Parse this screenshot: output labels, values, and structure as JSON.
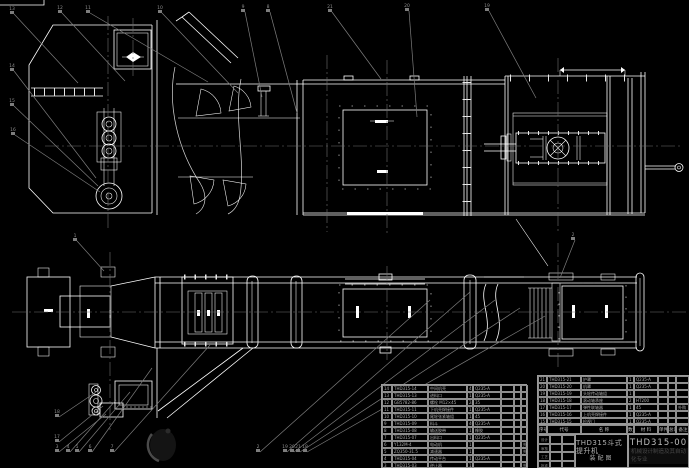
{
  "colors": {
    "background": "#000000",
    "line": "#ffffff",
    "leader": "#7d7d7d",
    "table_line": "#9a9a9a",
    "table_text": "#aeaeae",
    "title_text": "#bcbcbc",
    "org_text": "#474747",
    "watermark": "#161616"
  },
  "title_block": {
    "product": "THD315斗式提升机",
    "doc_type": "装配图",
    "drawing_no": "THD315-00",
    "org": "机械设计制造及其自动化专业",
    "signature_labels": [
      "设计",
      "审核",
      "工艺",
      "批准"
    ]
  },
  "bom": {
    "header": [
      "序号",
      "代号",
      "名 称",
      "数量",
      "材 料",
      "单件",
      "总计",
      "备注"
    ],
    "right_rows": [
      [
        "21",
        "THD315-21",
        "护罩",
        "1",
        "Q235-A",
        "",
        "",
        ""
      ],
      [
        "20",
        "THD315-20",
        "机罩",
        "1",
        "Q235-A",
        "",
        "",
        ""
      ],
      [
        "19",
        "THD315-19",
        "头轮传动轴组",
        "1",
        "",
        "",
        "",
        ""
      ],
      [
        "18",
        "THD315-18",
        "滚动轴承座",
        "2",
        "HT200",
        "",
        "",
        ""
      ],
      [
        "17",
        "THD315-17",
        "弹性联轴器",
        "1",
        "45",
        "",
        "",
        "外购"
      ],
      [
        "16",
        "THD315-16",
        "上机壳焊接件",
        "1",
        "Q235-A",
        "",
        "",
        ""
      ],
      [
        "15",
        "THD315-15",
        "检视门",
        "1",
        "Q235-A",
        "",
        "",
        ""
      ]
    ],
    "left_rows": [
      [
        "14",
        "THD315-14",
        "中间机壳",
        "4",
        "Q235-A",
        "",
        "",
        ""
      ],
      [
        "13",
        "THD315-13",
        "进料口",
        "1",
        "Q235-A",
        "",
        "",
        ""
      ],
      [
        "12",
        "GB5782-86",
        "螺栓 M12×45",
        "24",
        "35",
        "",
        "",
        ""
      ],
      [
        "11",
        "THD315-11",
        "下机壳焊接件",
        "1",
        "Q235-A",
        "",
        "",
        ""
      ],
      [
        "10",
        "THD315-10",
        "尾轮张紧轴组",
        "1",
        "45",
        "",
        "",
        ""
      ],
      [
        "9",
        "THD315-09",
        "料斗",
        "46",
        "Q235-A",
        "",
        "",
        ""
      ],
      [
        "8",
        "THD315-08",
        "输送胶带",
        "1",
        "橡胶",
        "",
        "",
        ""
      ],
      [
        "7",
        "THD315-07",
        "出料口",
        "1",
        "Q235-A",
        "",
        "",
        ""
      ],
      [
        "6",
        "Y132M-4",
        "电动机",
        "1",
        "",
        "",
        "",
        "外购"
      ],
      [
        "5",
        "ZQ350-31.5",
        "减速器",
        "1",
        "",
        "",
        "",
        "外购"
      ],
      [
        "4",
        "THD315-04",
        "传动平台",
        "1",
        "Q235-A",
        "",
        "",
        ""
      ],
      [
        "3",
        "THD315-03",
        "逆止器",
        "1",
        "",
        "",
        "",
        "外购"
      ]
    ]
  },
  "callouts": [
    {
      "n": "13",
      "bx": 12,
      "by": 11,
      "lx": 78,
      "ly": 83
    },
    {
      "n": "12",
      "bx": 60,
      "by": 10,
      "lx": 125,
      "ly": 81
    },
    {
      "n": "11",
      "bx": 88,
      "by": 10,
      "lx": 208,
      "ly": 82
    },
    {
      "n": "10",
      "bx": 160,
      "by": 10,
      "lx": 238,
      "ly": 93
    },
    {
      "n": "9",
      "bx": 243,
      "by": 9,
      "lx": 262,
      "ly": 97
    },
    {
      "n": "8",
      "bx": 268,
      "by": 9,
      "lx": 297,
      "ly": 113
    },
    {
      "n": "21",
      "bx": 330,
      "by": 9,
      "lx": 381,
      "ly": 79
    },
    {
      "n": "20",
      "bx": 407,
      "by": 8,
      "lx": 417,
      "ly": 117
    },
    {
      "n": "19",
      "bx": 487,
      "by": 8,
      "lx": 536,
      "ly": 98
    },
    {
      "n": "14",
      "bx": 12,
      "by": 68,
      "lx": 96,
      "ly": 178
    },
    {
      "n": "15",
      "bx": 12,
      "by": 103,
      "lx": 98,
      "ly": 186
    },
    {
      "n": "16",
      "bx": 13,
      "by": 132,
      "lx": 100,
      "ly": 192
    },
    {
      "n": "1",
      "bx": 75,
      "by": 238,
      "lx": 104,
      "ly": 271
    },
    {
      "n": "2",
      "bx": 573,
      "by": 237,
      "lx": 560,
      "ly": 278
    },
    {
      "n": "18",
      "bx": 57,
      "by": 414,
      "lx": 96,
      "ly": 392
    },
    {
      "n": "17",
      "bx": 57,
      "by": 439,
      "lx": 103,
      "ly": 406
    },
    {
      "n": "3",
      "bx": 57,
      "by": 449,
      "lx": 106,
      "ly": 414
    },
    {
      "n": "4",
      "bx": 68,
      "by": 449,
      "lx": 116,
      "ly": 400
    },
    {
      "n": "5",
      "bx": 77,
      "by": 449,
      "lx": 130,
      "ly": 392
    },
    {
      "n": "6",
      "bx": 90,
      "by": 449,
      "lx": 152,
      "ly": 368
    },
    {
      "n": "7",
      "bx": 112,
      "by": 449,
      "lx": 210,
      "ly": 345
    },
    {
      "n": "2",
      "bx": 258,
      "by": 449,
      "lx": 430,
      "ly": 300
    },
    {
      "n": "19",
      "bx": 285,
      "by": 449,
      "lx": 470,
      "ly": 292
    },
    {
      "n": "20",
      "bx": 292,
      "by": 449,
      "lx": 495,
      "ly": 300
    },
    {
      "n": "21",
      "bx": 298,
      "by": 449,
      "lx": 520,
      "ly": 308
    },
    {
      "n": "18",
      "bx": 305,
      "by": 449,
      "lx": 545,
      "ly": 316
    }
  ]
}
